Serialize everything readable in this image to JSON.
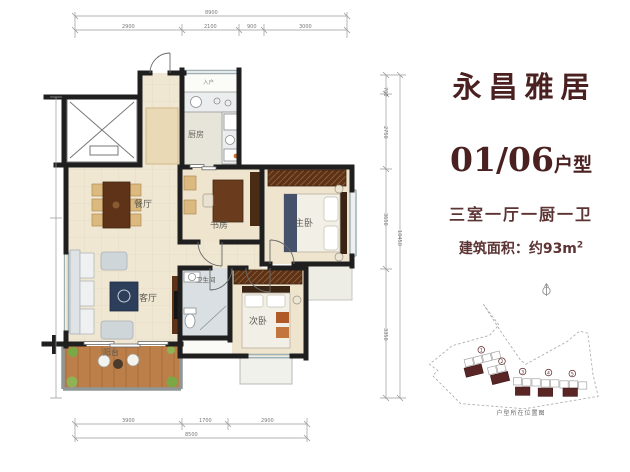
{
  "right_panel": {
    "title": "永昌雅居",
    "unit_code": "01/06",
    "unit_type_suffix": "户型",
    "layout_desc": "三室一厅一厨一卫",
    "area_prefix": "建筑面积：约93m",
    "area_superscript": "2",
    "site_caption": "户型所在位置图",
    "site_numbers": [
      "1",
      "2",
      "3",
      "4",
      "5"
    ]
  },
  "floorplan": {
    "rooms": {
      "entry": "入户",
      "kitchen": "厨房",
      "dining": "餐厅",
      "study": "书房",
      "master": "主卧",
      "living": "客厅",
      "bath": "卫生间",
      "second": "次卧",
      "balcony": "阳台"
    },
    "dims": {
      "top_total": "8900",
      "top_segs": [
        "2900",
        "2100",
        "900",
        "3000"
      ],
      "right_total": "10450",
      "right_segs": [
        "700",
        "2750",
        "3650",
        "3350"
      ],
      "bottom_total": "8500",
      "bottom_segs": [
        "3900",
        "1700",
        "2900"
      ]
    }
  },
  "colors": {
    "accent_maroon": "#4a2020",
    "body_text": "#5d3434",
    "wall_black": "#1f1f1f",
    "floor_beige": "#f0e7d3",
    "balcony_wood": "#bc7f4a",
    "site_building": "#5a2525"
  }
}
